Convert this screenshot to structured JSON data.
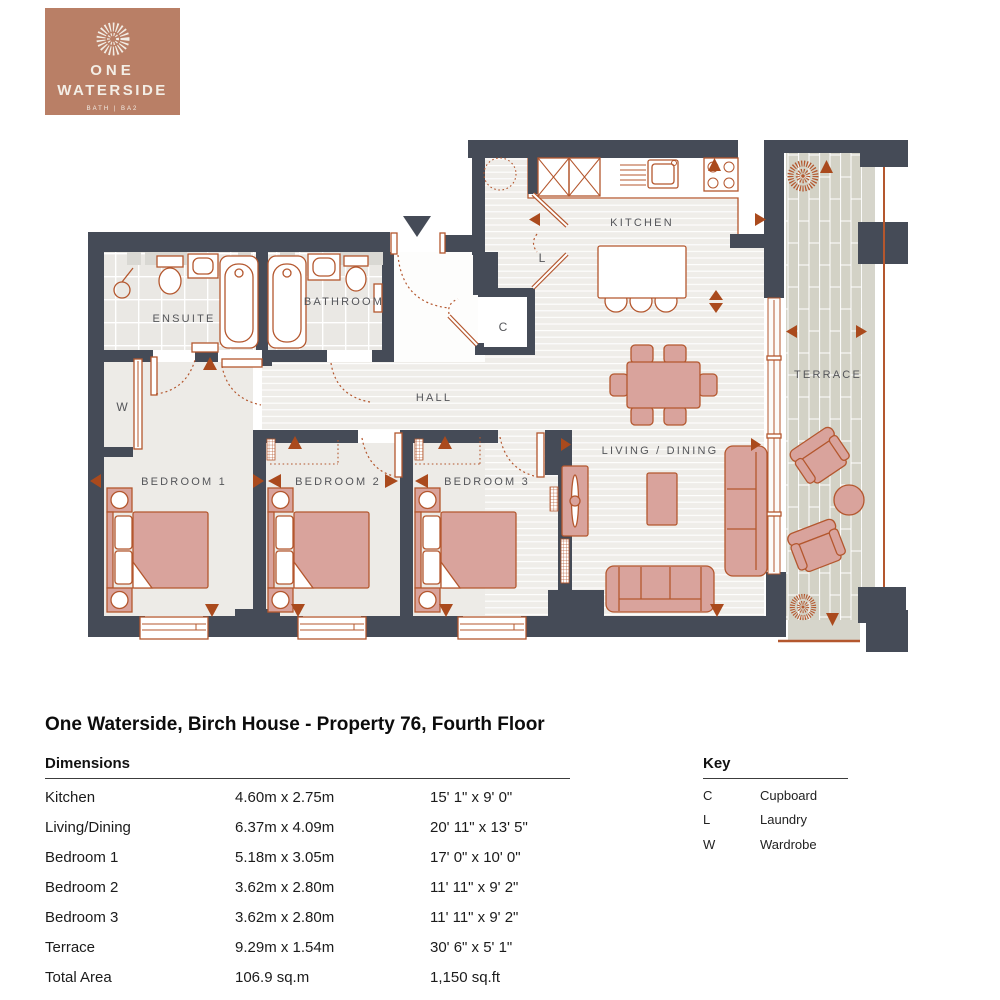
{
  "logo": {
    "name_line1": "ONE",
    "name_line2": "WATERSIDE",
    "tagline": "BATH | BA2",
    "icon": "sunburst-icon"
  },
  "plan": {
    "rooms": {
      "kitchen": "KITCHEN",
      "living_dining": "LIVING / DINING",
      "hall": "HALL",
      "ensuite": "ENSUITE",
      "bathroom": "BATHROOM",
      "bedroom1": "BEDROOM 1",
      "bedroom2": "BEDROOM 2",
      "bedroom3": "BEDROOM 3",
      "terrace": "TERRACE",
      "cupboard_abbr": "C",
      "laundry_abbr": "L",
      "wardrobe_abbr": "W"
    },
    "colors": {
      "wall": "#454b57",
      "accent": "#b4572e",
      "arrow": "#aa4a1d",
      "furniture": "#d9a39c",
      "floor": "#efede9",
      "tile": "#eae8e4",
      "terrace": "#d3d2c6",
      "label": "#55565a",
      "brand": "#b97f66",
      "brand_text": "#f3eee6"
    }
  },
  "title": "One Waterside, Birch House - Property 76, Fourth Floor",
  "dimensions": {
    "heading": "Dimensions",
    "rows": [
      {
        "room": "Kitchen",
        "metric": "4.60m x 2.75m",
        "imperial": "15' 1\" x 9' 0\""
      },
      {
        "room": "Living/Dining",
        "metric": "6.37m x 4.09m",
        "imperial": "20' 11\" x 13' 5\""
      },
      {
        "room": "Bedroom 1",
        "metric": "5.18m x 3.05m",
        "imperial": "17' 0\" x 10' 0\""
      },
      {
        "room": "Bedroom 2",
        "metric": "3.62m x 2.80m",
        "imperial": "11' 11\" x 9' 2\""
      },
      {
        "room": "Bedroom 3",
        "metric": "3.62m x 2.80m",
        "imperial": "11' 11\" x 9' 2\""
      },
      {
        "room": "Terrace",
        "metric": "9.29m x 1.54m",
        "imperial": "30' 6\" x 5' 1\""
      },
      {
        "room": "Total Area",
        "metric": "106.9 sq.m",
        "imperial": "1,150 sq.ft"
      }
    ]
  },
  "key": {
    "heading": "Key",
    "items": [
      {
        "code": "C",
        "label": "Cupboard"
      },
      {
        "code": "L",
        "label": "Laundry"
      },
      {
        "code": "W",
        "label": "Wardrobe"
      }
    ]
  }
}
